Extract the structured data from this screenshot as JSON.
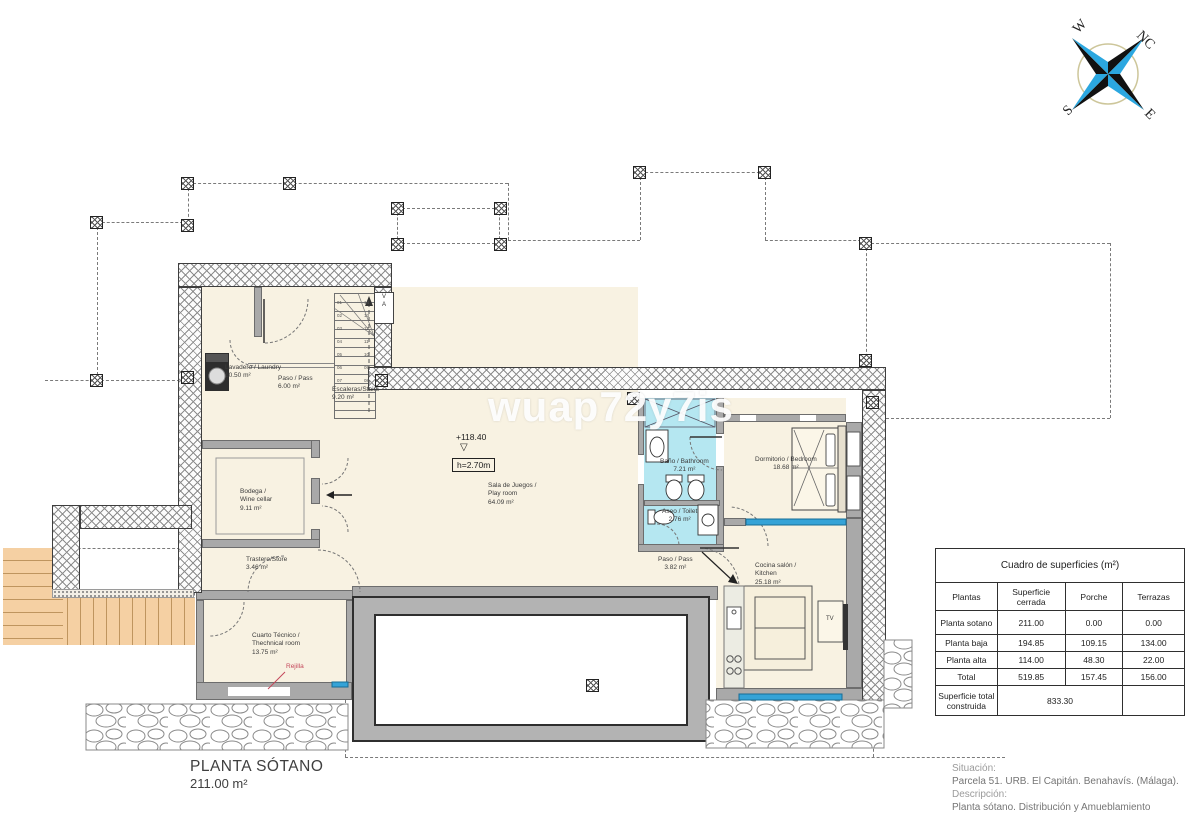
{
  "watermark": "wuap72y7is",
  "compass": {
    "n": "NC",
    "e": "E",
    "s": "S",
    "w": "W"
  },
  "plan": {
    "title": "PLANTA SÓTANO",
    "area": "211.00 m²",
    "level_mark": "+118.40",
    "level_symbol": "▽",
    "height_mark": "h=2.70m",
    "rejilla": "Rejilla",
    "tv": "TV",
    "shaft_v": "V",
    "shaft_a": "A",
    "rooms": {
      "lavadero": {
        "name": "Lavadero / Laundry",
        "area": "10.50 m²"
      },
      "paso1": {
        "name": "Paso / Pass",
        "area": "6.00 m²"
      },
      "escaleras": {
        "name": "Escaleras/Stairs",
        "area": "9.20 m²"
      },
      "bodega": {
        "name1": "Bodega /",
        "name2": "Wine cellar",
        "area": "9.11 m²"
      },
      "trastero": {
        "name": "Trastero/Store",
        "area": "3.46 m²"
      },
      "sala": {
        "name1": "Sala de Juegos /",
        "name2": "Play room",
        "area": "64.09 m²"
      },
      "bano": {
        "name": "Baño / Bathroom",
        "area": "7.21 m²"
      },
      "aseo": {
        "name": "Aseo / Toilet",
        "area": "2.76 m²"
      },
      "dormitorio": {
        "name": "Dormitorio / Bedroom",
        "area": "18.68 m²"
      },
      "paso2": {
        "name": "Paso / Pass",
        "area": "3.82 m²"
      },
      "cocina": {
        "name1": "Cocina salón /",
        "name2": "Kitchen",
        "area": "25.18 m²"
      },
      "cuarto": {
        "name1": "Cuarto Técnico /",
        "name2": "Thechnical room",
        "area": "13.75 m²"
      }
    },
    "stairs": {
      "left": [
        "01",
        "02",
        "03",
        "04",
        "05",
        "06",
        "07"
      ],
      "right": [
        "14",
        "13",
        "12",
        "11",
        "10",
        "09",
        "08"
      ]
    }
  },
  "surfaces_table": {
    "title": "Cuadro de superficies (m²)",
    "col_headers": [
      "Plantas",
      "Superficie cerrada",
      "Porche",
      "Terrazas"
    ],
    "rows": [
      {
        "label": "Planta sotano",
        "cerrada": "211.00",
        "porche": "0.00",
        "terrazas": "0.00"
      },
      {
        "label": "Planta baja",
        "cerrada": "194.85",
        "porche": "109.15",
        "terrazas": "134.00"
      },
      {
        "label": "Planta alta",
        "cerrada": "114.00",
        "porche": "48.30",
        "terrazas": "22.00"
      },
      {
        "label": "Total",
        "cerrada": "519.85",
        "porche": "157.45",
        "terrazas": "156.00"
      }
    ],
    "total_label": "Superficie total construida",
    "total_value": "833.30"
  },
  "info": {
    "situacion_label": "Situación:",
    "situacion": "Parcela 51. URB. El Capitán. Benahavís. (Málaga).",
    "descripcion_label": "Descripción:",
    "descripcion": "Planta sótano. Distribución y Amueblamiento"
  },
  "colors": {
    "room_fill": "#f8f2e2",
    "bath_fill": "#b5e7f1",
    "wall_gray": "#a9a9a9",
    "stairs_orange": "#f5d0a3",
    "accent_blue": "#35a3d7",
    "label_red": "#c4475a"
  }
}
